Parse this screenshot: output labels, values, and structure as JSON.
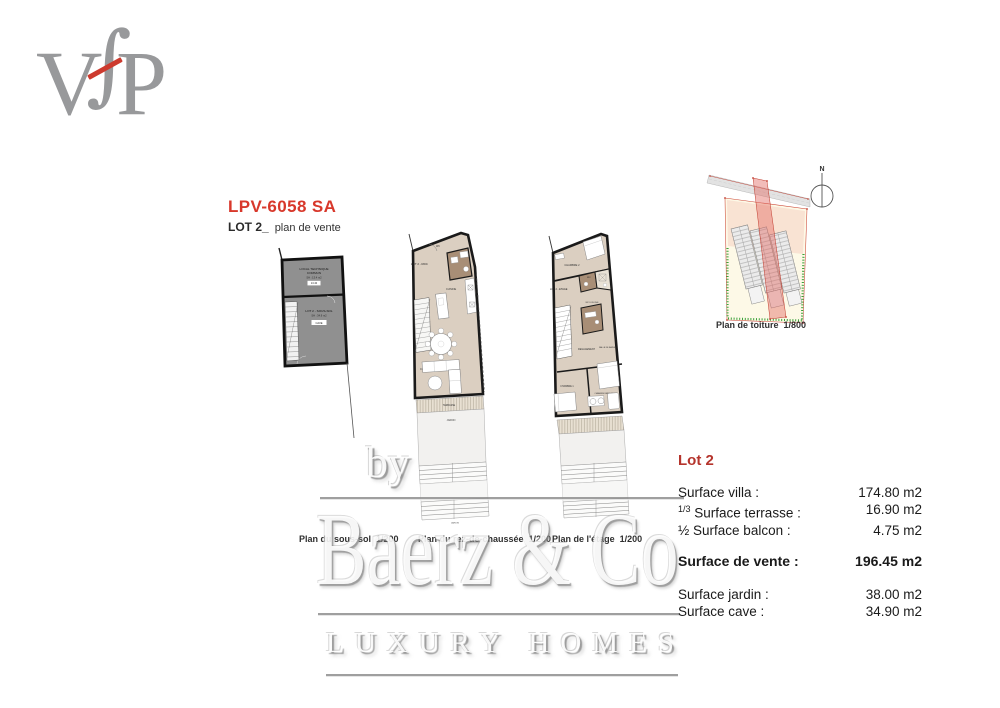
{
  "page": {
    "bg": "#ffffff"
  },
  "logo": {
    "letter_v": "V",
    "letter_f": "∫",
    "letter_p": "P",
    "letter_color": "#98999b",
    "accent_color": "#cd3a2e"
  },
  "header": {
    "title": "LPV-6058 SA",
    "title_color": "#d8382b",
    "lot": "LOT 2_",
    "subtitle": "plan de vente"
  },
  "plans": {
    "sous_sol": {
      "caption": "Plan du sous-sol  1/200",
      "room1_l1": "LOCAL TECHNIQUE",
      "room1_l2": "COMMUN",
      "room1_area": "SH : 13.4 m2",
      "room1_chip": "13.40",
      "room2_name": "LOT 2 - SOUS-SOL",
      "room2_area": "SH : 34.9 m2",
      "room2_chip": "CAVE"
    },
    "rdc": {
      "caption": "Plan du rez-de-chaussée  1/200",
      "lot_label": "LOT 2 - RDC",
      "wc": "WC",
      "kitchen": "CUISINE",
      "living": "COIN A MANGER - SEJOUR",
      "terrace": "TERRASSE",
      "garden": "JARDIN",
      "garden2": "JARDIN"
    },
    "etage": {
      "caption": "Plan de l'étage  1/200",
      "lot_label": "LOT 2 - ETAGE",
      "bedroom2": "CHAMBRE 2",
      "wc": "WC",
      "shower_room": "WC DOUCHE",
      "bath": "SALLE DE BAINS",
      "hall": "DEGAGEMENT",
      "bedroom1": "CHAMBRE 1",
      "master": "CHAMBRE PARENTALE"
    },
    "toiture": {
      "caption": "Plan de toiture  1/800",
      "north": "N"
    }
  },
  "table": {
    "title": "Lot 2",
    "title_color": "#b5342c",
    "rows": [
      {
        "prefix": "",
        "label": "Surface villa :",
        "value": "174.80 m2"
      },
      {
        "prefix": "1/3",
        "label": "Surface terrasse :",
        "value": "16.90 m2"
      },
      {
        "prefix": "½",
        "label": "Surface balcon :",
        "value": "4.75 m2"
      },
      {
        "prefix": "",
        "label": "Surface de vente :",
        "value": "196.45 m2"
      },
      {
        "prefix": "",
        "label": "Surface jardin :",
        "value": "38.00 m2"
      },
      {
        "prefix": "",
        "label": "Surface cave :",
        "value": "34.90 m2"
      }
    ]
  },
  "watermark": {
    "by": "by",
    "brand": "Baerz & Co",
    "tagline": "LUXURY HOMES"
  },
  "colors": {
    "floor_beige": "#dbcfc1",
    "room_brown": "#a88e76",
    "basement_gray": "#909090",
    "site_yellow": "#fdf9e7",
    "highlight_pink": "#e26a64",
    "green_dotted": "#3aa23a",
    "red_lines": "#c0392b"
  }
}
